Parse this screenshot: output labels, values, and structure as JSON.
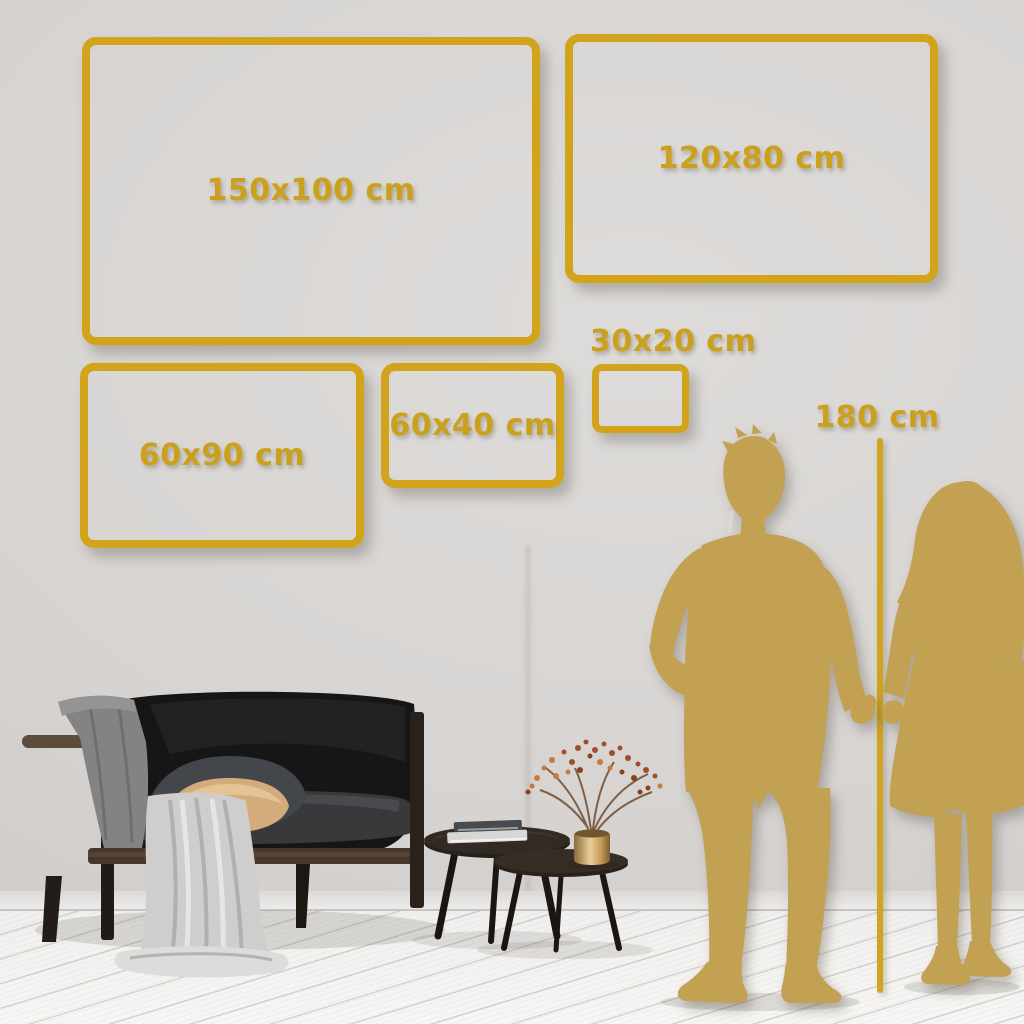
{
  "page": {
    "title": "Wall art canvas size comparison guide"
  },
  "frames": [
    {
      "name": "size-frame-150x100",
      "label": "150x100 cm"
    },
    {
      "name": "size-frame-120x80",
      "label": "120x80 cm"
    },
    {
      "name": "size-frame-60x90",
      "label": "60x90 cm"
    },
    {
      "name": "size-frame-60x40",
      "label": "60x40 cm"
    },
    {
      "name": "size-frame-30x20",
      "label": "30x20 cm"
    }
  ],
  "height_ruler": {
    "label": "180 cm"
  },
  "colors": {
    "frame_gold": "#d2a41b",
    "label_gold": "#cba01c",
    "silhouette_gold": "#c3a152",
    "wall": "#d7d4d2",
    "floor": "#f3f2f0",
    "sofa_black": "#161616",
    "tan_pillow": "#d4ac7c",
    "blanket_gray": "#cfcecc",
    "brass_vase": "#c79b58"
  },
  "illustrations": [
    {
      "name": "man-silhouette"
    },
    {
      "name": "woman-silhouette"
    },
    {
      "name": "sofa"
    },
    {
      "name": "throw-blanket"
    },
    {
      "name": "cushions"
    },
    {
      "name": "nesting-coffee-tables"
    },
    {
      "name": "books-stack"
    },
    {
      "name": "brass-vase-dried-branches"
    }
  ]
}
